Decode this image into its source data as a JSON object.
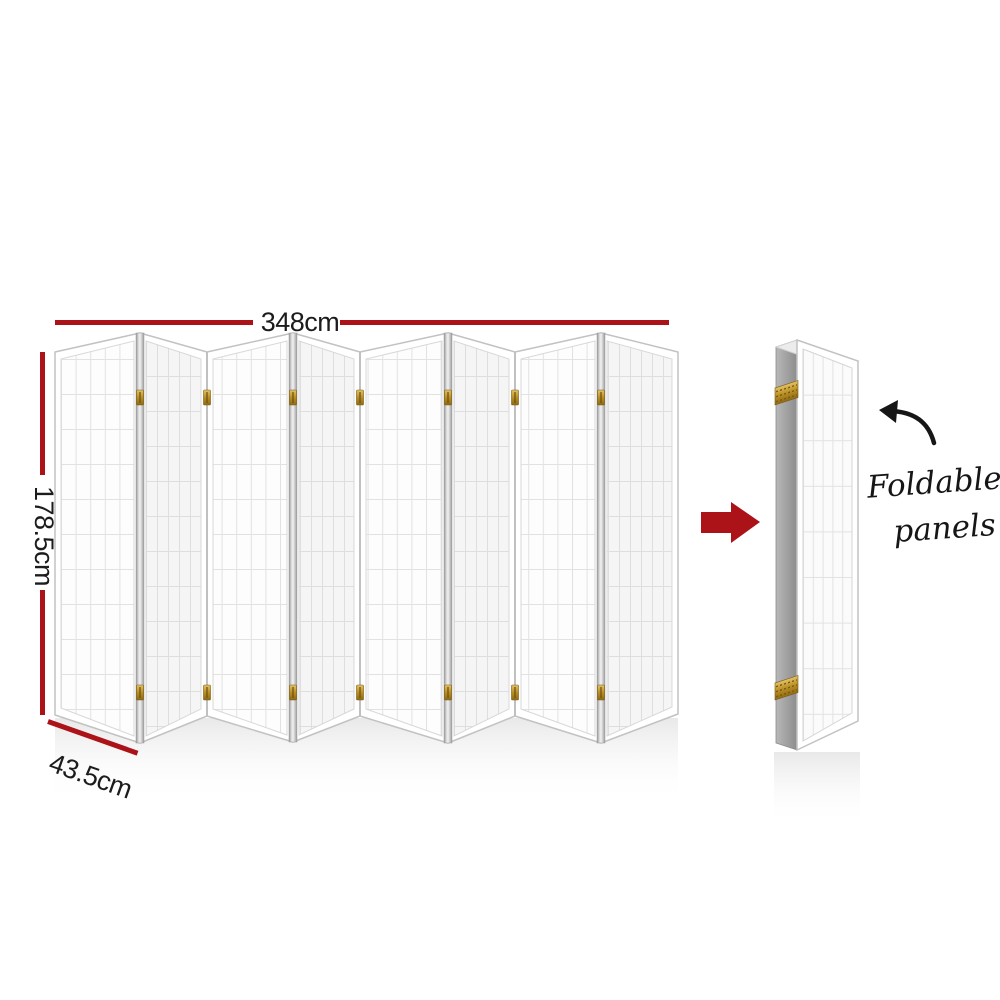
{
  "product_diagram": {
    "type": "room-divider-dimension-diagram",
    "dimensions": {
      "width": "348cm",
      "height": "178.5cm",
      "depth": "43.5cm"
    },
    "annotation": {
      "line1": "Foldable",
      "line2": "panels"
    },
    "screen": {
      "panel_count": 8,
      "grid_columns_per_panel": 5
    },
    "colors": {
      "dimension_red": "#ab1319",
      "arrow_red": "#ab1319",
      "hinge_gold": "#c49a33",
      "edge_gray": "#a5a5a5",
      "text_black": "#1c1c1c"
    },
    "icons": {
      "fold_direction": "arrow-right-icon",
      "annotation_pointer": "curved-arrow-icon"
    }
  }
}
